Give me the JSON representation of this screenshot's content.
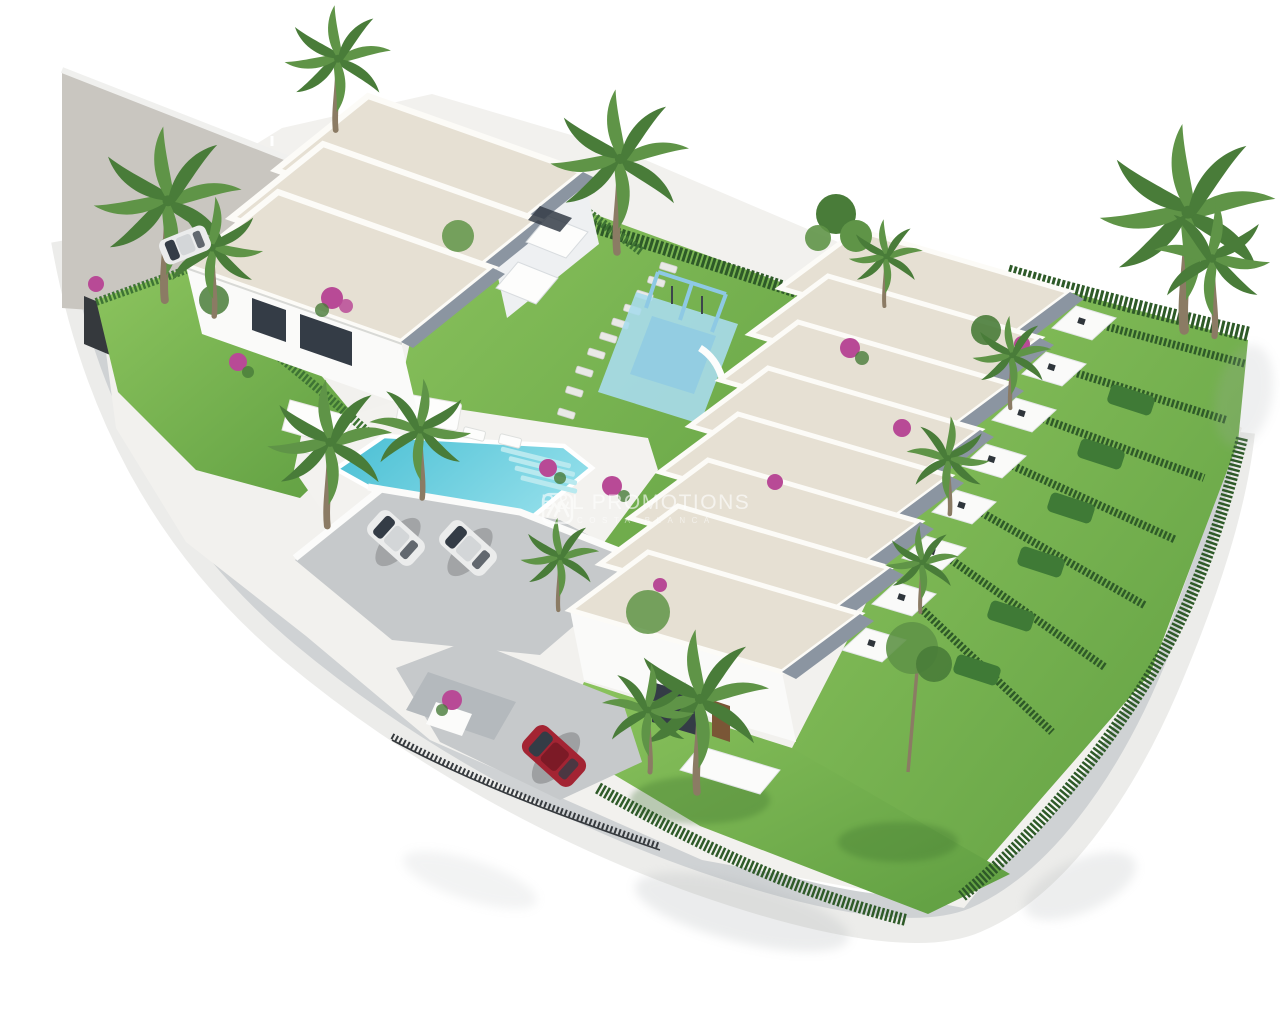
{
  "watermark": {
    "brand": "B&L PROMOTIONS",
    "tagline": "COSTA BLANCA",
    "logo_icon": "double-roof-house-icon"
  },
  "scene": {
    "type": "3d-architectural-rendering",
    "view": "aerial-isometric",
    "left_building_units": 3,
    "right_row_units": 8,
    "amenities": [
      "swimming-pool",
      "children-playground",
      "parking-area",
      "private-gardens",
      "palm-trees"
    ],
    "vehicles": {
      "white_cars": 3,
      "red_cars": 1
    }
  },
  "palette": {
    "bg": "#ffffff",
    "base": "#f2f1ee",
    "yard": "#c9c6c0",
    "road": "#cfd2d4",
    "curb": "#ececea",
    "wallband": "#f8f8f6",
    "grass1": "#8cc45e",
    "grass2": "#5f9e41",
    "grassdark": "#3a6e2c",
    "hedge": "#2e5a28",
    "hedge2": "#3e7434",
    "boxhedge": "#3f7a36",
    "roof": "#e6e0d3",
    "roofedge": "#fcfbf7",
    "wall": "#fafaf9",
    "wallshade": "#eef0f2",
    "fascia": "#8b95a1",
    "glass": "#343c46",
    "door": "#7a5636",
    "pool1": "#49bfd4",
    "pool2": "#8fdde9",
    "poolstep": "#b8e9ef",
    "deck": "#f3f2ef",
    "park": "#c6c9cb",
    "carwhite": "#ebecec",
    "carroof": "#d3d6d8",
    "carred": "#a32433",
    "carreddark": "#7c1a26",
    "fence": "#35393d",
    "trunk": "#8b7b64",
    "palm1": "#5f9447",
    "palm2": "#497c39",
    "flower": "#b84a96",
    "shadow": "#a7acaf",
    "playfloor": "#a9dcec",
    "playframe": "#8ec9e4",
    "stone": "#e9e9e6",
    "canopy": "#b4b9bd",
    "wm": "#ffffff"
  }
}
